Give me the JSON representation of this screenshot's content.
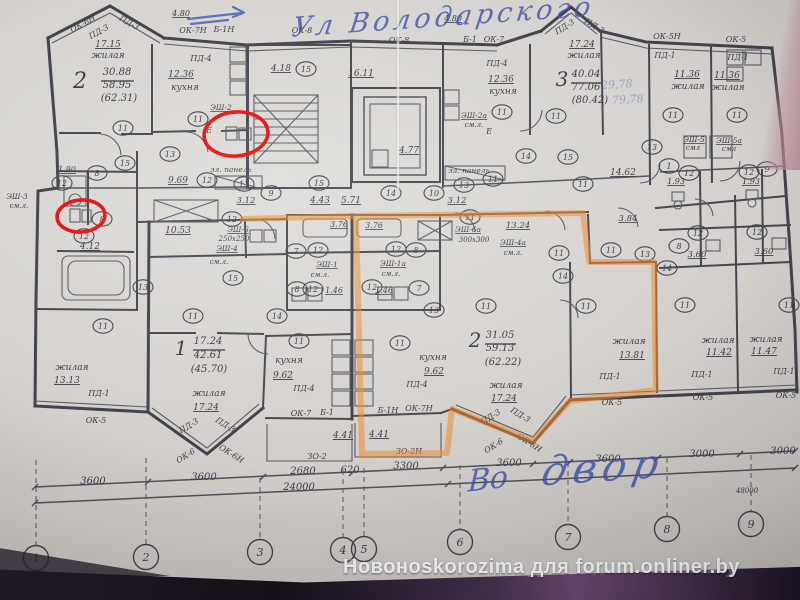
{
  "watermark": {
    "text": "Новоноskorozima для forum.onliner.by"
  },
  "annotations": {
    "street_note": "Ул Володарского",
    "yard_note_1": "Во",
    "yard_note_2": "двор"
  },
  "colors": {
    "paper": "#d5d2cf",
    "ink": "#42424c",
    "highlighter_orange": "#ef8a28",
    "marker_red": "#e01212",
    "pen_blue": "#4a5fae",
    "watermark_text": "#fdfdfd"
  },
  "plan": {
    "labels": [
      {
        "t": "ОК-6Н",
        "x": 84,
        "y": 26,
        "r": -29,
        "f": 8
      },
      {
        "t": "ПД-3",
        "x": 100,
        "y": 34,
        "r": -29,
        "f": 8
      },
      {
        "t": "ПД-3",
        "x": 128,
        "y": 25,
        "r": 29,
        "f": 8
      },
      {
        "t": "17.15",
        "x": 108,
        "y": 47,
        "f": 9,
        "u": 1
      },
      {
        "t": "жилая",
        "x": 108,
        "y": 58,
        "f": 9,
        "n": "room-label-living"
      },
      {
        "t": "2",
        "x": 80,
        "y": 88,
        "f": 22,
        "n": "apartment-2-number"
      },
      {
        "t": "30.88",
        "x": 117,
        "y": 75,
        "f": 10
      },
      {
        "t": "58.95",
        "x": 117,
        "y": 88,
        "f": 10
      },
      {
        "t": "(62.31)",
        "x": 119,
        "y": 101,
        "f": 10
      },
      {
        "t": "4.80",
        "x": 181,
        "y": 16,
        "f": 8,
        "u": 1
      },
      {
        "t": "ОК-7Н",
        "x": 193,
        "y": 33,
        "f": 8
      },
      {
        "t": "Б-1Н",
        "x": 224,
        "y": 32,
        "f": 8
      },
      {
        "t": "ПД-4",
        "x": 201,
        "y": 61,
        "f": 8
      },
      {
        "t": "12.36",
        "x": 181,
        "y": 77,
        "f": 9,
        "u": 1
      },
      {
        "t": "кухня",
        "x": 185,
        "y": 90,
        "f": 9,
        "n": "room-label-kitchen"
      },
      {
        "t": "ЭШ-2",
        "x": 221,
        "y": 110,
        "f": 7.5,
        "u": 1
      },
      {
        "t": "Е",
        "x": 209,
        "y": 133,
        "f": 8
      },
      {
        "t": "эл. панель",
        "x": 231,
        "y": 172,
        "f": 7.5
      },
      {
        "t": "1.90",
        "x": 67,
        "y": 172,
        "f": 8,
        "u": 1
      },
      {
        "t": "9.69",
        "x": 178,
        "y": 183,
        "f": 9,
        "u": 1
      },
      {
        "t": "ЭШ-3",
        "x": 17,
        "y": 199,
        "f": 7.5
      },
      {
        "t": "см.л.",
        "x": 19,
        "y": 208,
        "f": 7
      },
      {
        "t": "4.12",
        "x": 90,
        "y": 249,
        "f": 9,
        "u": 1
      },
      {
        "t": "10.53",
        "x": 178,
        "y": 233,
        "f": 9,
        "u": 1
      },
      {
        "t": "3.12",
        "x": 246,
        "y": 203,
        "f": 8.5,
        "u": 1
      },
      {
        "t": "ЭШ-6",
        "x": 238,
        "y": 232,
        "f": 7.5,
        "u": 1
      },
      {
        "t": "250x250",
        "x": 234,
        "y": 241,
        "f": 7
      },
      {
        "t": "ЭШ-4",
        "x": 227,
        "y": 251,
        "f": 7.5,
        "u": 1
      },
      {
        "t": "см.л.",
        "x": 219,
        "y": 264,
        "f": 7
      },
      {
        "t": "жилая",
        "x": 72,
        "y": 370,
        "f": 9
      },
      {
        "t": "13.13",
        "x": 67,
        "y": 383,
        "f": 9,
        "u": 1
      },
      {
        "t": "ПД-1",
        "x": 99,
        "y": 396,
        "f": 8
      },
      {
        "t": "ОК-5",
        "x": 96,
        "y": 423,
        "f": 8
      },
      {
        "t": "1",
        "x": 181,
        "y": 355,
        "f": 20,
        "n": "apartment-1-number"
      },
      {
        "t": "17.24",
        "x": 208,
        "y": 344,
        "f": 10
      },
      {
        "t": "42.61",
        "x": 208,
        "y": 358,
        "f": 10
      },
      {
        "t": "(45.70)",
        "x": 209,
        "y": 372,
        "f": 10
      },
      {
        "t": "жилая",
        "x": 209,
        "y": 396,
        "f": 9
      },
      {
        "t": "17.24",
        "x": 206,
        "y": 410,
        "f": 9,
        "u": 1
      },
      {
        "t": "ПД-3",
        "x": 190,
        "y": 428,
        "r": -32,
        "f": 8
      },
      {
        "t": "ПД-3",
        "x": 224,
        "y": 427,
        "r": 32,
        "f": 8
      },
      {
        "t": "ОК-6",
        "x": 187,
        "y": 458,
        "r": -32,
        "f": 8
      },
      {
        "t": "ОК-6Н",
        "x": 230,
        "y": 456,
        "r": 32,
        "f": 8
      },
      {
        "t": "ОК-8",
        "x": 302,
        "y": 33,
        "f": 8
      },
      {
        "t": "4.18",
        "x": 281,
        "y": 71,
        "f": 9,
        "u": 1
      },
      {
        "t": "16.11",
        "x": 361,
        "y": 76,
        "f": 9,
        "u": 1
      },
      {
        "t": "ОК-8",
        "x": 399,
        "y": 43,
        "f": 8
      },
      {
        "t": "4.77",
        "x": 409,
        "y": 153,
        "f": 9,
        "u": 1
      },
      {
        "t": "Б-1",
        "x": 470,
        "y": 42,
        "f": 8
      },
      {
        "t": "ОК-7",
        "x": 494,
        "y": 42,
        "f": 8
      },
      {
        "t": "4.80",
        "x": 453,
        "y": 21,
        "f": 8,
        "u": 1
      },
      {
        "t": "ПД-4",
        "x": 497,
        "y": 66,
        "f": 8
      },
      {
        "t": "12.36",
        "x": 501,
        "y": 82,
        "f": 9,
        "u": 1
      },
      {
        "t": "кухня",
        "x": 503,
        "y": 94,
        "f": 9
      },
      {
        "t": "ЭШ-2а",
        "x": 474,
        "y": 118,
        "f": 7.5,
        "u": 1
      },
      {
        "t": "см.л.",
        "x": 474,
        "y": 127,
        "f": 7
      },
      {
        "t": "Е",
        "x": 489,
        "y": 134,
        "f": 8
      },
      {
        "t": "эл. панель",
        "x": 469,
        "y": 173,
        "f": 7.5
      },
      {
        "t": "3.12",
        "x": 457,
        "y": 203,
        "f": 8.5,
        "u": 1
      },
      {
        "t": "4.43",
        "x": 320,
        "y": 203,
        "f": 9,
        "u": 1
      },
      {
        "t": "5.71",
        "x": 351,
        "y": 203,
        "f": 9,
        "u": 1
      },
      {
        "t": "3.76",
        "x": 339,
        "y": 227,
        "f": 8,
        "u": 1
      },
      {
        "t": "3.76",
        "x": 374,
        "y": 228,
        "f": 8,
        "u": 1
      },
      {
        "t": "ЭШ-1",
        "x": 327,
        "y": 267,
        "f": 7.5,
        "u": 1
      },
      {
        "t": "см.л.",
        "x": 320,
        "y": 277,
        "f": 7
      },
      {
        "t": "ЭШ-1а",
        "x": 393,
        "y": 266,
        "f": 7.5,
        "u": 1
      },
      {
        "t": "см.л.",
        "x": 391,
        "y": 276,
        "f": 7
      },
      {
        "t": "1.46",
        "x": 334,
        "y": 293,
        "f": 8,
        "u": 1
      },
      {
        "t": "1.46",
        "x": 384,
        "y": 293,
        "f": 8,
        "u": 1
      },
      {
        "t": "ЭШ-6а",
        "x": 468,
        "y": 232,
        "f": 7.5,
        "u": 1
      },
      {
        "t": "300x300",
        "x": 474,
        "y": 242,
        "f": 7
      },
      {
        "t": "13.24",
        "x": 518,
        "y": 228,
        "f": 8.5,
        "u": 1
      },
      {
        "t": "ЭШ-4а",
        "x": 513,
        "y": 245,
        "f": 7.5,
        "u": 1
      },
      {
        "t": "см.л.",
        "x": 513,
        "y": 255,
        "f": 7
      },
      {
        "t": "кухня",
        "x": 289,
        "y": 363,
        "f": 9
      },
      {
        "t": "9.62",
        "x": 283,
        "y": 378,
        "f": 9,
        "u": 1
      },
      {
        "t": "ПД-4",
        "x": 304,
        "y": 391,
        "f": 8
      },
      {
        "t": "ОК-7",
        "x": 301,
        "y": 416,
        "f": 8
      },
      {
        "t": "Б-1",
        "x": 327,
        "y": 415,
        "f": 8
      },
      {
        "t": "кухня",
        "x": 433,
        "y": 360,
        "f": 9
      },
      {
        "t": "9.62",
        "x": 434,
        "y": 374,
        "f": 9,
        "u": 1
      },
      {
        "t": "ПД-4",
        "x": 417,
        "y": 387,
        "f": 8
      },
      {
        "t": "Б-1Н",
        "x": 388,
        "y": 413,
        "f": 8
      },
      {
        "t": "ОК-7Н",
        "x": 419,
        "y": 411,
        "f": 8
      },
      {
        "t": "4.41",
        "x": 343,
        "y": 438,
        "f": 9,
        "u": 1
      },
      {
        "t": "4.41",
        "x": 379,
        "y": 437,
        "f": 9,
        "u": 1
      },
      {
        "t": "ЗО-2",
        "x": 317,
        "y": 459,
        "f": 8
      },
      {
        "t": "ЗО-2Н",
        "x": 409,
        "y": 454,
        "f": 8
      },
      {
        "t": "2",
        "x": 475,
        "y": 347,
        "f": 20,
        "n": "apartment-2b-number"
      },
      {
        "t": "31.05",
        "x": 500,
        "y": 338,
        "f": 10
      },
      {
        "t": "59.13",
        "x": 500,
        "y": 351,
        "f": 10
      },
      {
        "t": "(62.22)",
        "x": 503,
        "y": 365,
        "f": 10
      },
      {
        "t": "жилая",
        "x": 506,
        "y": 388,
        "f": 9
      },
      {
        "t": "17.24",
        "x": 504,
        "y": 401,
        "f": 9,
        "u": 1
      },
      {
        "t": "ПД-3",
        "x": 492,
        "y": 419,
        "r": -32,
        "f": 8
      },
      {
        "t": "ПД-3",
        "x": 519,
        "y": 417,
        "r": 32,
        "f": 8
      },
      {
        "t": "ОК-6",
        "x": 495,
        "y": 448,
        "r": -32,
        "f": 8
      },
      {
        "t": "ОК-6Н",
        "x": 528,
        "y": 445,
        "r": 32,
        "f": 8
      },
      {
        "t": "ПД-3",
        "x": 566,
        "y": 29,
        "r": -32,
        "f": 8
      },
      {
        "t": "ПД-3",
        "x": 593,
        "y": 28,
        "r": 32,
        "f": 8
      },
      {
        "t": "17.24",
        "x": 582,
        "y": 47,
        "f": 9,
        "u": 1
      },
      {
        "t": "жилая",
        "x": 584,
        "y": 58,
        "f": 9
      },
      {
        "t": "3",
        "x": 562,
        "y": 86,
        "f": 20,
        "n": "apartment-3-number"
      },
      {
        "t": "40.04",
        "x": 586,
        "y": 77,
        "f": 10
      },
      {
        "t": "77.06",
        "x": 586,
        "y": 90,
        "f": 10
      },
      {
        "t": "(80.42)",
        "x": 590,
        "y": 103,
        "f": 10
      },
      {
        "t": "ОК-5Н",
        "x": 667,
        "y": 39,
        "f": 8
      },
      {
        "t": "ПД-1",
        "x": 665,
        "y": 58,
        "f": 8
      },
      {
        "t": "ОК-5",
        "x": 736,
        "y": 42,
        "f": 8
      },
      {
        "t": "ПД-1",
        "x": 738,
        "y": 60,
        "f": 8
      },
      {
        "t": "11.36",
        "x": 687,
        "y": 77,
        "f": 9,
        "u": 1
      },
      {
        "t": "жилая",
        "x": 688,
        "y": 89,
        "f": 9
      },
      {
        "t": "11.36",
        "x": 727,
        "y": 78,
        "f": 9,
        "u": 1
      },
      {
        "t": "жилая",
        "x": 728,
        "y": 90,
        "f": 9
      },
      {
        "t": "ЭШ-5",
        "x": 694,
        "y": 142,
        "f": 7.5,
        "u": 1
      },
      {
        "t": "смл",
        "x": 693,
        "y": 150,
        "f": 7
      },
      {
        "t": "ЭШ-5а",
        "x": 729,
        "y": 143,
        "f": 7.5,
        "u": 1
      },
      {
        "t": "смл",
        "x": 729,
        "y": 151,
        "f": 7
      },
      {
        "t": "14.62",
        "x": 623,
        "y": 175,
        "f": 9,
        "u": 1
      },
      {
        "t": "1.93",
        "x": 676,
        "y": 184,
        "f": 8,
        "u": 1
      },
      {
        "t": "1.93",
        "x": 751,
        "y": 184,
        "f": 8,
        "u": 1
      },
      {
        "t": "3.84",
        "x": 628,
        "y": 221,
        "f": 8.5,
        "u": 1
      },
      {
        "t": "3.60",
        "x": 697,
        "y": 257,
        "f": 8.5,
        "u": 1
      },
      {
        "t": "3.60",
        "x": 764,
        "y": 254,
        "f": 8.5,
        "u": 1
      },
      {
        "t": "жилая",
        "x": 629,
        "y": 344,
        "f": 9
      },
      {
        "t": "13.81",
        "x": 632,
        "y": 358,
        "f": 9,
        "u": 1
      },
      {
        "t": "жилая",
        "x": 718,
        "y": 343,
        "f": 9
      },
      {
        "t": "11.42",
        "x": 719,
        "y": 355,
        "f": 9,
        "u": 1
      },
      {
        "t": "жилая",
        "x": 766,
        "y": 342,
        "f": 9
      },
      {
        "t": "11.47",
        "x": 764,
        "y": 354,
        "f": 9,
        "u": 1
      },
      {
        "t": "ПД-1",
        "x": 610,
        "y": 379,
        "f": 8
      },
      {
        "t": "ОК-5",
        "x": 612,
        "y": 405,
        "f": 8
      },
      {
        "t": "ПД-1",
        "x": 702,
        "y": 377,
        "f": 8
      },
      {
        "t": "ОК-5",
        "x": 703,
        "y": 400,
        "f": 8
      },
      {
        "t": "ПД-1",
        "x": 784,
        "y": 374,
        "f": 8
      },
      {
        "t": "ОК-5",
        "x": 786,
        "y": 398,
        "f": 8
      },
      {
        "t": "3600",
        "x": 93,
        "y": 484,
        "f": 10
      },
      {
        "t": "3600",
        "x": 204,
        "y": 480,
        "f": 10
      },
      {
        "t": "2680",
        "x": 303,
        "y": 474,
        "f": 10
      },
      {
        "t": "620",
        "x": 350,
        "y": 473,
        "f": 10
      },
      {
        "t": "3300",
        "x": 406,
        "y": 469,
        "f": 10
      },
      {
        "t": "3600",
        "x": 509,
        "y": 466,
        "f": 10
      },
      {
        "t": "3600",
        "x": 608,
        "y": 462,
        "f": 10
      },
      {
        "t": "3000",
        "x": 702,
        "y": 457,
        "f": 10
      },
      {
        "t": "3000",
        "x": 783,
        "y": 454,
        "f": 10
      },
      {
        "t": "24000",
        "x": 299,
        "y": 490,
        "f": 10
      },
      {
        "t": "48000",
        "x": 747,
        "y": 493,
        "f": 7
      }
    ],
    "faint_pen_numbers": [
      {
        "t": "29,78",
        "x": 617,
        "y": 88
      },
      {
        "t": "79,78",
        "x": 628,
        "y": 103
      }
    ],
    "bubbles": [
      {
        "n": "11",
        "x": 123,
        "y": 128
      },
      {
        "n": "11",
        "x": 198,
        "y": 119
      },
      {
        "n": "8",
        "x": 97,
        "y": 173
      },
      {
        "n": "12",
        "x": 62,
        "y": 183
      },
      {
        "n": "15",
        "x": 125,
        "y": 163
      },
      {
        "n": "13",
        "x": 170,
        "y": 154
      },
      {
        "n": "12",
        "x": 207,
        "y": 180
      },
      {
        "n": "13",
        "x": 244,
        "y": 184
      },
      {
        "n": "8",
        "x": 102,
        "y": 219
      },
      {
        "n": "12",
        "x": 84,
        "y": 236
      },
      {
        "n": "12",
        "x": 232,
        "y": 219
      },
      {
        "n": "15",
        "x": 233,
        "y": 278
      },
      {
        "n": "13",
        "x": 143,
        "y": 287
      },
      {
        "n": "11",
        "x": 103,
        "y": 326
      },
      {
        "n": "11",
        "x": 193,
        "y": 316
      },
      {
        "n": "15",
        "x": 306,
        "y": 69
      },
      {
        "n": "15",
        "x": 319,
        "y": 183
      },
      {
        "n": "14",
        "x": 391,
        "y": 193
      },
      {
        "n": "10",
        "x": 434,
        "y": 193
      },
      {
        "n": "13",
        "x": 464,
        "y": 185
      },
      {
        "n": "11",
        "x": 493,
        "y": 179
      },
      {
        "n": "14",
        "x": 526,
        "y": 156
      },
      {
        "n": "11",
        "x": 502,
        "y": 112
      },
      {
        "n": "9",
        "x": 271,
        "y": 193
      },
      {
        "n": "7",
        "x": 296,
        "y": 251
      },
      {
        "n": "12",
        "x": 318,
        "y": 250
      },
      {
        "n": "12",
        "x": 396,
        "y": 249
      },
      {
        "n": "8",
        "x": 416,
        "y": 250
      },
      {
        "n": "8",
        "x": 297,
        "y": 289
      },
      {
        "n": "12",
        "x": 313,
        "y": 289
      },
      {
        "n": "12",
        "x": 372,
        "y": 287
      },
      {
        "n": "7",
        "x": 419,
        "y": 288
      },
      {
        "n": "13",
        "x": 434,
        "y": 310
      },
      {
        "n": "14",
        "x": 277,
        "y": 316
      },
      {
        "n": "11",
        "x": 299,
        "y": 341
      },
      {
        "n": "11",
        "x": 400,
        "y": 343
      },
      {
        "n": "11",
        "x": 470,
        "y": 217
      },
      {
        "n": "11",
        "x": 486,
        "y": 306
      },
      {
        "n": "11",
        "x": 556,
        "y": 116
      },
      {
        "n": "11",
        "x": 673,
        "y": 115
      },
      {
        "n": "11",
        "x": 737,
        "y": 115
      },
      {
        "n": "15",
        "x": 568,
        "y": 157
      },
      {
        "n": "13",
        "x": 652,
        "y": 147
      },
      {
        "n": "11",
        "x": 583,
        "y": 184
      },
      {
        "n": "1",
        "x": 669,
        "y": 166
      },
      {
        "n": "12",
        "x": 689,
        "y": 173
      },
      {
        "n": "12",
        "x": 749,
        "y": 172
      },
      {
        "n": "9",
        "x": 767,
        "y": 169
      },
      {
        "n": "12",
        "x": 698,
        "y": 233
      },
      {
        "n": "12",
        "x": 757,
        "y": 232
      },
      {
        "n": "8",
        "x": 679,
        "y": 246
      },
      {
        "n": "14",
        "x": 667,
        "y": 268
      },
      {
        "n": "14",
        "x": 563,
        "y": 276
      },
      {
        "n": "13",
        "x": 645,
        "y": 254
      },
      {
        "n": "11",
        "x": 611,
        "y": 250
      },
      {
        "n": "11",
        "x": 559,
        "y": 253
      },
      {
        "n": "11",
        "x": 586,
        "y": 306
      },
      {
        "n": "11",
        "x": 685,
        "y": 305
      },
      {
        "n": "11",
        "x": 789,
        "y": 305
      }
    ],
    "axis_bubbles": [
      {
        "n": "1",
        "x": 36,
        "y": 558
      },
      {
        "n": "2",
        "x": 146,
        "y": 557
      },
      {
        "n": "3",
        "x": 260,
        "y": 552
      },
      {
        "n": "4",
        "x": 343,
        "y": 550
      },
      {
        "n": "5",
        "x": 364,
        "y": 549
      },
      {
        "n": "6",
        "x": 460,
        "y": 542
      },
      {
        "n": "7",
        "x": 568,
        "y": 537
      },
      {
        "n": "8",
        "x": 667,
        "y": 529
      },
      {
        "n": "9",
        "x": 751,
        "y": 524
      }
    ]
  }
}
